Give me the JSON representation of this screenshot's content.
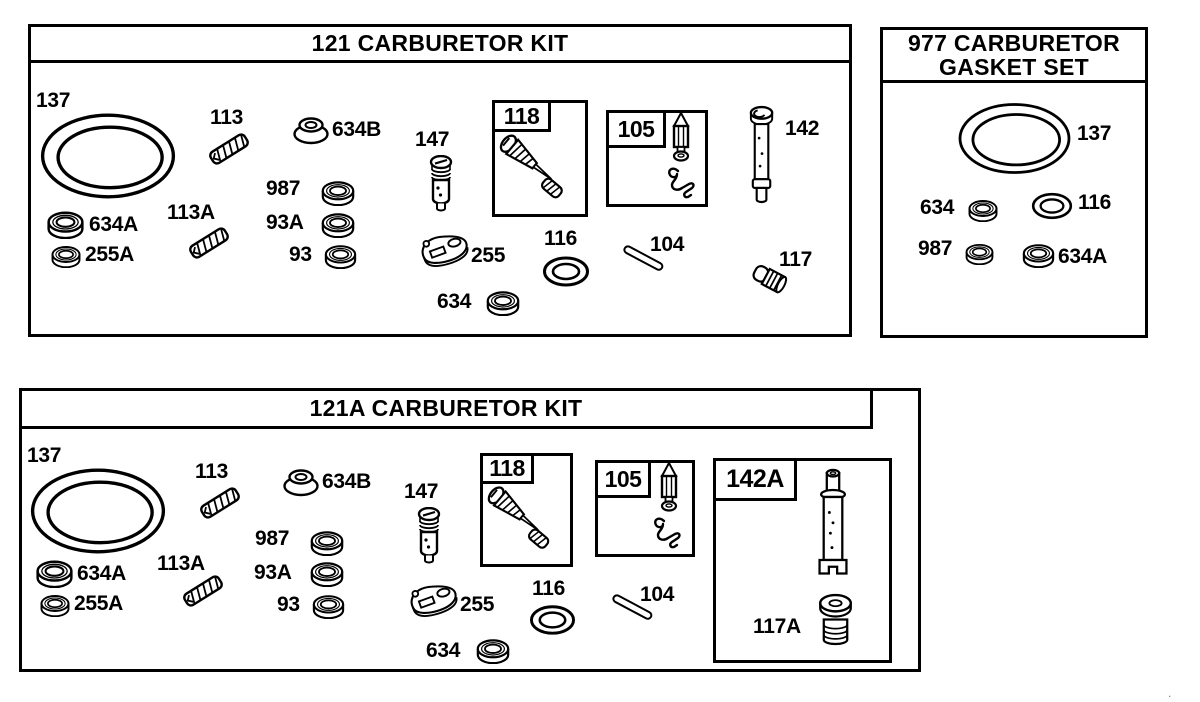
{
  "page": {
    "background": "#ffffff",
    "ink": "#000000",
    "corner_mark": "."
  },
  "diagram": {
    "panels": [
      {
        "id": "kit-121",
        "title": "121 CARBURETOR KIT",
        "frame": {
          "x": 28,
          "y": 24,
          "w": 824,
          "h": 313
        },
        "insets": [
          {
            "label": "118",
            "x": 492,
            "y": 100,
            "w": 96,
            "h": 117,
            "lw": 59,
            "lh": 32
          },
          {
            "label": "105",
            "x": 606,
            "y": 110,
            "w": 102,
            "h": 97,
            "lw": 60,
            "lh": 38
          }
        ],
        "parts": [
          {
            "label": "137",
            "part": "o-ring",
            "icon": "o-ring-icon",
            "sym": "ring",
            "lx": 36,
            "ly": 90,
            "ix": 36,
            "iy": 111,
            "iw": 144,
            "ih": 90
          },
          {
            "label": "113",
            "part": "spring",
            "icon": "spring-icon",
            "sym": "spring",
            "lx": 210,
            "ly": 107,
            "ix": 206,
            "iy": 130,
            "iw": 46,
            "ih": 38
          },
          {
            "label": "634B",
            "part": "seal",
            "icon": "seal-icon",
            "sym": "grommet",
            "lx": 332,
            "ly": 119,
            "ix": 291,
            "iy": 113,
            "iw": 40,
            "ih": 34
          },
          {
            "label": "147",
            "part": "needle valve",
            "icon": "needle-valve-icon",
            "sym": "valve",
            "lx": 415,
            "ly": 129,
            "ix": 427,
            "iy": 155,
            "iw": 28,
            "ih": 58
          },
          {
            "label": "987",
            "part": "washer",
            "icon": "washer-icon",
            "sym": "washer",
            "lx": 266,
            "ly": 178,
            "ix": 321,
            "iy": 179,
            "iw": 34,
            "ih": 27
          },
          {
            "label": "93A",
            "part": "seal washer",
            "icon": "washer-icon",
            "sym": "washer",
            "lx": 266,
            "ly": 212,
            "ix": 321,
            "iy": 211,
            "iw": 34,
            "ih": 27
          },
          {
            "label": "93",
            "part": "seal washer",
            "icon": "washer-icon",
            "sym": "washer",
            "lx": 289,
            "ly": 244,
            "ix": 324,
            "iy": 243,
            "iw": 33,
            "ih": 26
          },
          {
            "label": "634A",
            "part": "washer",
            "icon": "washer-icon",
            "sym": "washer",
            "lx": 89,
            "ly": 214,
            "ix": 46,
            "iy": 209,
            "iw": 39,
            "ih": 30
          },
          {
            "label": "255A",
            "part": "washer",
            "icon": "washer-icon",
            "sym": "washer",
            "lx": 85,
            "ly": 244,
            "ix": 51,
            "iy": 244,
            "iw": 30,
            "ih": 24
          },
          {
            "label": "113A",
            "part": "spring",
            "icon": "spring-icon",
            "sym": "spring",
            "lx": 167,
            "ly": 202,
            "ix": 186,
            "iy": 224,
            "iw": 46,
            "ih": 38
          },
          {
            "label": "255",
            "part": "pump gasket",
            "icon": "pump-gasket-icon",
            "sym": "gasket",
            "lx": 471,
            "ly": 245,
            "ix": 417,
            "iy": 231,
            "iw": 55,
            "ih": 38
          },
          {
            "label": "116",
            "part": "o-ring",
            "icon": "o-ring-icon",
            "sym": "oring",
            "lx": 544,
            "ly": 228,
            "ix": 542,
            "iy": 255,
            "iw": 48,
            "ih": 33
          },
          {
            "label": "104",
            "part": "pin",
            "icon": "pin-icon",
            "sym": "pin",
            "lx": 650,
            "ly": 234,
            "ix": 621,
            "iy": 244,
            "iw": 48,
            "ih": 32
          },
          {
            "label": "634",
            "part": "washer",
            "icon": "washer-icon",
            "sym": "washer",
            "lx": 437,
            "ly": 291,
            "ix": 486,
            "iy": 289,
            "iw": 34,
            "ih": 27
          },
          {
            "label": "142",
            "part": "main jet tube",
            "icon": "jet-tube-icon",
            "sym": "tube",
            "lx": 785,
            "ly": 118,
            "ix": 747,
            "iy": 104,
            "iw": 31,
            "ih": 103
          },
          {
            "label": "117",
            "part": "welch plug",
            "icon": "welch-plug-icon",
            "sym": "plug",
            "lx": 779,
            "ly": 249,
            "ix": 748,
            "iy": 263,
            "iw": 42,
            "ih": 36
          },
          {
            "label": "",
            "part": "needle assembly",
            "icon": "needle-jet-assembly-icon",
            "sym": "needle118",
            "ix": 497,
            "iy": 133,
            "iw": 86,
            "ih": 78
          },
          {
            "label": "",
            "part": "float needle",
            "icon": "float-needle-icon",
            "sym": "needle105",
            "ix": 669,
            "iy": 112,
            "iw": 24,
            "ih": 52
          },
          {
            "label": "",
            "part": "needle clip",
            "icon": "needle-clip-icon",
            "sym": "clip",
            "ix": 664,
            "iy": 165,
            "iw": 34,
            "ih": 36
          }
        ]
      },
      {
        "id": "gasket-977",
        "title_line1": "977 CARBURETOR",
        "title_line2": "GASKET SET",
        "frame": {
          "x": 880,
          "y": 27,
          "w": 268,
          "h": 311
        },
        "insets": [],
        "parts": [
          {
            "label": "137",
            "part": "o-ring",
            "icon": "o-ring-icon",
            "sym": "ring",
            "lx": 1077,
            "ly": 123,
            "ix": 955,
            "iy": 101,
            "iw": 119,
            "ih": 75
          },
          {
            "label": "634",
            "part": "washer",
            "icon": "washer-icon",
            "sym": "washer",
            "lx": 920,
            "ly": 197,
            "ix": 968,
            "iy": 198,
            "iw": 30,
            "ih": 24
          },
          {
            "label": "116",
            "part": "o-ring",
            "icon": "o-ring-icon",
            "sym": "oring",
            "lx": 1078,
            "ly": 192,
            "ix": 1030,
            "iy": 192,
            "iw": 44,
            "ih": 28
          },
          {
            "label": "987",
            "part": "washer",
            "icon": "washer-icon",
            "sym": "washer",
            "lx": 918,
            "ly": 238,
            "ix": 965,
            "iy": 242,
            "iw": 29,
            "ih": 23
          },
          {
            "label": "634A",
            "part": "washer",
            "icon": "washer-icon",
            "sym": "washer",
            "lx": 1058,
            "ly": 246,
            "ix": 1022,
            "iy": 242,
            "iw": 33,
            "ih": 26
          }
        ]
      },
      {
        "id": "kit-121a",
        "title": "121A CARBURETOR KIT",
        "frame": {
          "x": 19,
          "y": 388,
          "w": 902,
          "h": 284
        },
        "insets": [
          {
            "label": "118",
            "x": 480,
            "y": 453,
            "w": 93,
            "h": 114,
            "lw": 54,
            "lh": 31
          },
          {
            "label": "105",
            "x": 595,
            "y": 460,
            "w": 100,
            "h": 97,
            "lw": 56,
            "lh": 38
          },
          {
            "label": "142A",
            "x": 713,
            "y": 458,
            "w": 179,
            "h": 205,
            "lw": 84,
            "lh": 43
          }
        ],
        "parts": [
          {
            "label": "137",
            "part": "o-ring",
            "icon": "o-ring-icon",
            "sym": "ring",
            "lx": 27,
            "ly": 445,
            "ix": 27,
            "iy": 466,
            "iw": 142,
            "ih": 90
          },
          {
            "label": "113",
            "part": "spring",
            "icon": "spring-icon",
            "sym": "spring",
            "lx": 195,
            "ly": 461,
            "ix": 197,
            "iy": 484,
            "iw": 46,
            "ih": 38
          },
          {
            "label": "634B",
            "part": "seal",
            "icon": "seal-icon",
            "sym": "grommet",
            "lx": 322,
            "ly": 471,
            "ix": 281,
            "iy": 465,
            "iw": 40,
            "ih": 34
          },
          {
            "label": "147",
            "part": "needle valve",
            "icon": "needle-valve-icon",
            "sym": "valve",
            "lx": 404,
            "ly": 481,
            "ix": 415,
            "iy": 507,
            "iw": 28,
            "ih": 58
          },
          {
            "label": "987",
            "part": "washer",
            "icon": "washer-icon",
            "sym": "washer",
            "lx": 255,
            "ly": 528,
            "ix": 310,
            "iy": 529,
            "iw": 34,
            "ih": 27
          },
          {
            "label": "93A",
            "part": "seal washer",
            "icon": "washer-icon",
            "sym": "washer",
            "lx": 254,
            "ly": 562,
            "ix": 310,
            "iy": 560,
            "iw": 34,
            "ih": 27
          },
          {
            "label": "93",
            "part": "seal washer",
            "icon": "washer-icon",
            "sym": "washer",
            "lx": 277,
            "ly": 594,
            "ix": 312,
            "iy": 593,
            "iw": 33,
            "ih": 26
          },
          {
            "label": "634A",
            "part": "washer",
            "icon": "washer-icon",
            "sym": "washer",
            "lx": 77,
            "ly": 563,
            "ix": 35,
            "iy": 558,
            "iw": 39,
            "ih": 30
          },
          {
            "label": "255A",
            "part": "washer",
            "icon": "washer-icon",
            "sym": "washer",
            "lx": 74,
            "ly": 593,
            "ix": 40,
            "iy": 593,
            "iw": 30,
            "ih": 24
          },
          {
            "label": "113A",
            "part": "spring",
            "icon": "spring-icon",
            "sym": "spring",
            "lx": 157,
            "ly": 553,
            "ix": 180,
            "iy": 572,
            "iw": 46,
            "ih": 38
          },
          {
            "label": "255",
            "part": "pump gasket",
            "icon": "pump-gasket-icon",
            "sym": "gasket",
            "lx": 460,
            "ly": 594,
            "ix": 406,
            "iy": 581,
            "iw": 55,
            "ih": 38
          },
          {
            "label": "116",
            "part": "o-ring",
            "icon": "o-ring-icon",
            "sym": "oring",
            "lx": 532,
            "ly": 578,
            "ix": 529,
            "iy": 604,
            "iw": 47,
            "ih": 32
          },
          {
            "label": "104",
            "part": "pin",
            "icon": "pin-icon",
            "sym": "pin",
            "lx": 640,
            "ly": 584,
            "ix": 610,
            "iy": 593,
            "iw": 48,
            "ih": 32
          },
          {
            "label": "634",
            "part": "washer",
            "icon": "washer-icon",
            "sym": "washer",
            "lx": 426,
            "ly": 640,
            "ix": 476,
            "iy": 637,
            "iw": 34,
            "ih": 27
          },
          {
            "label": "117A",
            "part": "welch plug",
            "icon": "welch-plug-icon",
            "sym": "plugv",
            "lx": 753,
            "ly": 616,
            "ix": 817,
            "iy": 593,
            "iw": 37,
            "ih": 53
          },
          {
            "label": "",
            "part": "needle assembly",
            "icon": "needle-jet-assembly-icon",
            "sym": "needle118",
            "ix": 485,
            "iy": 485,
            "iw": 84,
            "ih": 76
          },
          {
            "label": "",
            "part": "float needle",
            "icon": "float-needle-icon",
            "sym": "needle105",
            "ix": 657,
            "iy": 462,
            "iw": 24,
            "ih": 52
          },
          {
            "label": "",
            "part": "needle clip",
            "icon": "needle-clip-icon",
            "sym": "clip",
            "ix": 650,
            "iy": 515,
            "iw": 34,
            "ih": 36
          },
          {
            "label": "",
            "part": "main jet tube",
            "icon": "jet-tube-icon",
            "sym": "tubea",
            "ix": 812,
            "iy": 468,
            "iw": 42,
            "ih": 122
          }
        ]
      }
    ]
  }
}
